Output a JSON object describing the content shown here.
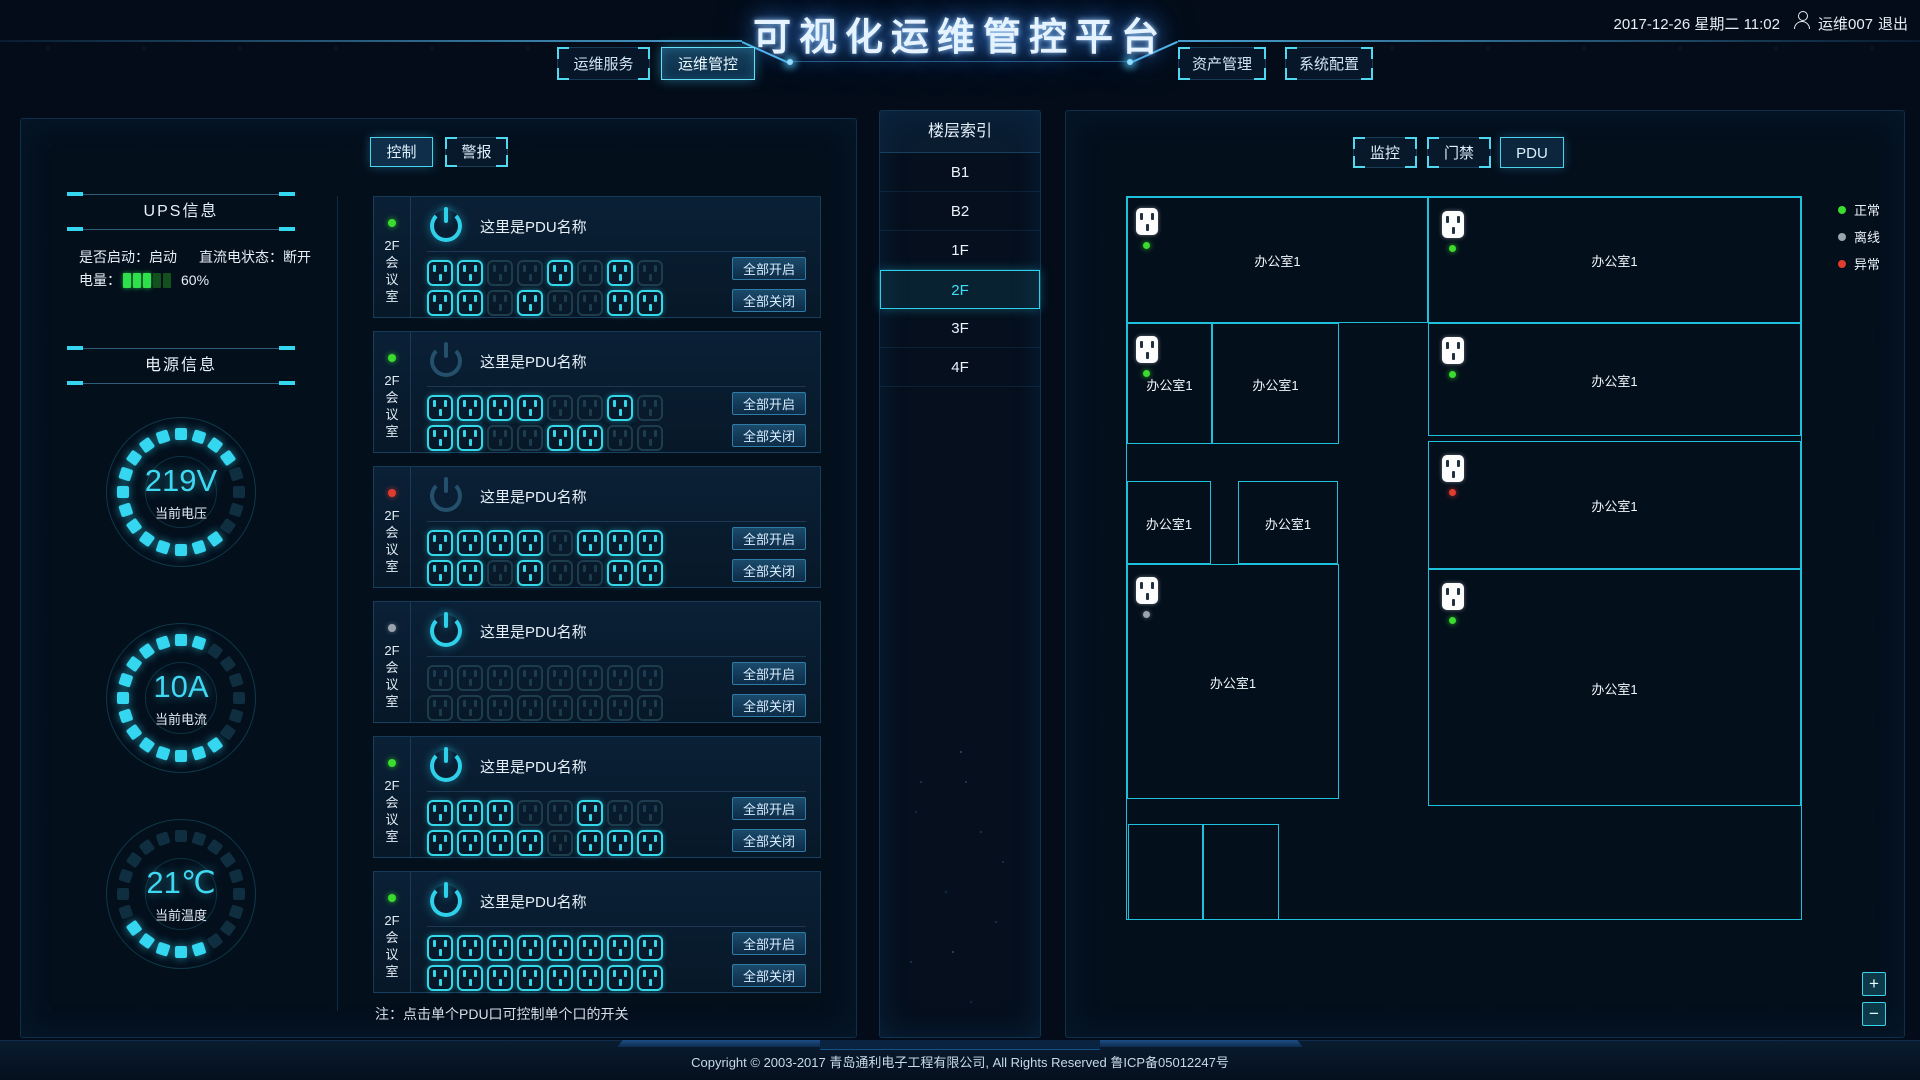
{
  "header": {
    "title": "可视化运维管控平台",
    "datetime": "2017-12-26 星期二  11:02",
    "user": "运维007",
    "logout": "退出",
    "nav_left": [
      {
        "label": "运维服务",
        "active": false
      },
      {
        "label": "运维管控",
        "active": true
      }
    ],
    "nav_right": [
      {
        "label": "资产管理",
        "active": false
      },
      {
        "label": "系统配置",
        "active": false
      }
    ]
  },
  "ups": {
    "title": "UPS信息",
    "started_label": "是否启动：启动",
    "dc_label": "直流电状态：断开",
    "battery_label": "电量：",
    "battery_percent": "60%",
    "battery_bars_on": 3,
    "battery_bars_total": 5
  },
  "power": {
    "title": "电源信息",
    "gauges": [
      {
        "value": "219V",
        "label": "当前电压",
        "segments": [
          1,
          1,
          1,
          1,
          0,
          0,
          0,
          0,
          1,
          1,
          1,
          1,
          1,
          1,
          1,
          1,
          1,
          1,
          1,
          1
        ]
      },
      {
        "value": "10A",
        "label": "当前电流",
        "segments": [
          1,
          1,
          0,
          0,
          0,
          0,
          0,
          0,
          1,
          1,
          1,
          1,
          1,
          1,
          1,
          1,
          1,
          1,
          1,
          1
        ]
      },
      {
        "value": "21℃",
        "label": "当前温度",
        "segments": [
          0,
          0,
          0,
          0,
          0,
          0,
          0,
          0,
          0,
          1,
          1,
          1,
          1,
          1,
          0,
          0,
          0,
          0,
          0,
          0
        ]
      }
    ]
  },
  "control": {
    "tabs": [
      {
        "label": "控制",
        "active": true
      },
      {
        "label": "警报",
        "active": false
      }
    ],
    "open_all": "全部开启",
    "close_all": "全部关闭",
    "note": "注：点击单个PDU口可控制单个口的开关",
    "pdus": [
      {
        "location": "2F会议室",
        "location_lines": [
          "2F",
          "会",
          "议",
          "室"
        ],
        "name": "这里是PDU名称",
        "status": "green",
        "power_on": true,
        "rows": [
          [
            1,
            1,
            0,
            0,
            1,
            0,
            1,
            0
          ],
          [
            1,
            1,
            0,
            1,
            0,
            0,
            1,
            1
          ]
        ]
      },
      {
        "location": "2F会议室",
        "location_lines": [
          "2F",
          "会",
          "议",
          "室"
        ],
        "name": "这里是PDU名称",
        "status": "green",
        "power_on": false,
        "rows": [
          [
            1,
            1,
            1,
            1,
            0,
            0,
            1,
            0
          ],
          [
            1,
            1,
            0,
            0,
            1,
            1,
            0,
            0
          ]
        ]
      },
      {
        "location": "2F会议室",
        "location_lines": [
          "2F",
          "会",
          "议",
          "室"
        ],
        "name": "这里是PDU名称",
        "status": "red",
        "power_on": false,
        "rows": [
          [
            1,
            1,
            1,
            1,
            0,
            1,
            1,
            1
          ],
          [
            1,
            1,
            0,
            1,
            0,
            0,
            1,
            1
          ]
        ]
      },
      {
        "location": "2F会议室",
        "location_lines": [
          "2F",
          "会",
          "议",
          "室"
        ],
        "name": "这里是PDU名称",
        "status": "gray",
        "power_on": true,
        "rows": [
          [
            0,
            0,
            0,
            0,
            0,
            0,
            0,
            0
          ],
          [
            0,
            0,
            0,
            0,
            0,
            0,
            0,
            0
          ]
        ]
      },
      {
        "location": "2F会议室",
        "location_lines": [
          "2F",
          "会",
          "议",
          "室"
        ],
        "name": "这里是PDU名称",
        "status": "green",
        "power_on": true,
        "rows": [
          [
            1,
            1,
            1,
            0,
            0,
            1,
            0,
            0
          ],
          [
            1,
            1,
            1,
            1,
            0,
            1,
            1,
            1
          ]
        ]
      },
      {
        "location": "2F会议室",
        "location_lines": [
          "2F",
          "会",
          "议",
          "室"
        ],
        "name": "这里是PDU名称",
        "status": "green",
        "power_on": true,
        "rows": [
          [
            1,
            1,
            1,
            1,
            1,
            1,
            1,
            1
          ],
          [
            1,
            1,
            1,
            1,
            1,
            1,
            1,
            1
          ]
        ]
      }
    ]
  },
  "floors": {
    "title": "楼层索引",
    "items": [
      {
        "label": "B1",
        "active": false
      },
      {
        "label": "B2",
        "active": false
      },
      {
        "label": "1F",
        "active": false
      },
      {
        "label": "2F",
        "active": true
      },
      {
        "label": "3F",
        "active": false
      },
      {
        "label": "4F",
        "active": false
      }
    ]
  },
  "monitor": {
    "tabs": [
      {
        "label": "监控",
        "active": false
      },
      {
        "label": "门禁",
        "active": false
      },
      {
        "label": "PDU",
        "active": true
      }
    ],
    "legend": [
      {
        "label": "正常",
        "color": "#3bdc2e"
      },
      {
        "label": "离线",
        "color": "#9aa4ad"
      },
      {
        "label": "异常",
        "color": "#e23b30"
      }
    ],
    "zoom_in": "+",
    "zoom_out": "−",
    "rooms": [
      {
        "name": "办公室1",
        "socket": "green"
      },
      {
        "name": "办公室1",
        "socket": "green"
      },
      {
        "name": "办公室1",
        "socket": "green"
      },
      {
        "name": "办公室1",
        "socket": null
      },
      {
        "name": "办公室1",
        "socket": "green"
      },
      {
        "name": "办公室1",
        "socket": null
      },
      {
        "name": "办公室1",
        "socket": null
      },
      {
        "name": "办公室1",
        "socket": "red"
      },
      {
        "name": "办公室1",
        "socket": "gray"
      },
      {
        "name": "办公室1",
        "socket": "green"
      },
      {
        "name": "",
        "socket": null
      },
      {
        "name": "",
        "socket": null
      }
    ]
  },
  "footer": {
    "text": "Copyright © 2003-2017 青岛通利电子工程有限公司, All Rights Reserved   鲁ICP备05012247号"
  },
  "colors": {
    "accent": "#2fd0ea",
    "normal": "#3bdc2e",
    "offline": "#9aa4ad",
    "alarm": "#e23b30",
    "battery_on": "#2ee04c"
  }
}
